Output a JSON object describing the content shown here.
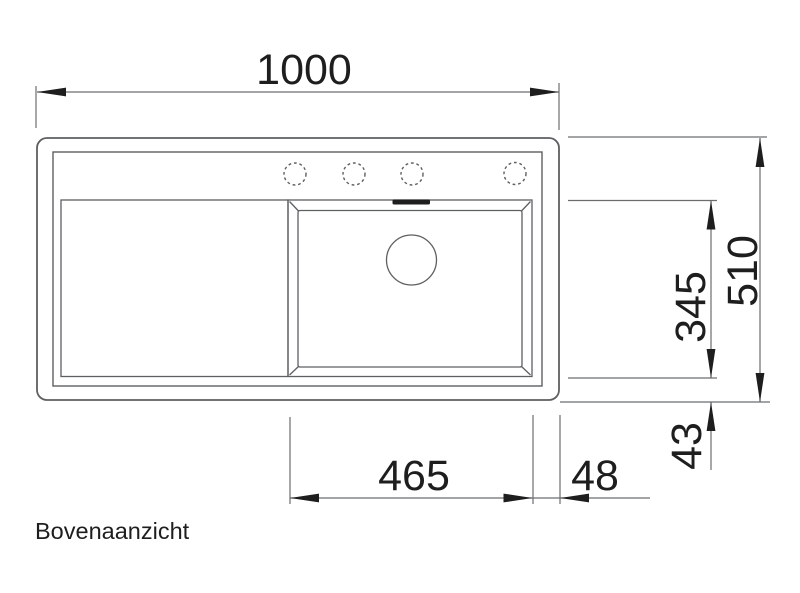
{
  "title": "Bovenaanzicht",
  "dimensions": {
    "total_width_mm": "1000",
    "total_depth_mm": "510",
    "bowl_depth_mm": "345",
    "bowl_width_mm": "465",
    "bowl_right_offset_mm": "48",
    "bowl_bottom_offset_mm": "43"
  },
  "colors": {
    "background": "#ffffff",
    "drawing_line": "#5d5f61",
    "dimension_line": "#6b6d6f",
    "ink": "#1e1e1e"
  }
}
